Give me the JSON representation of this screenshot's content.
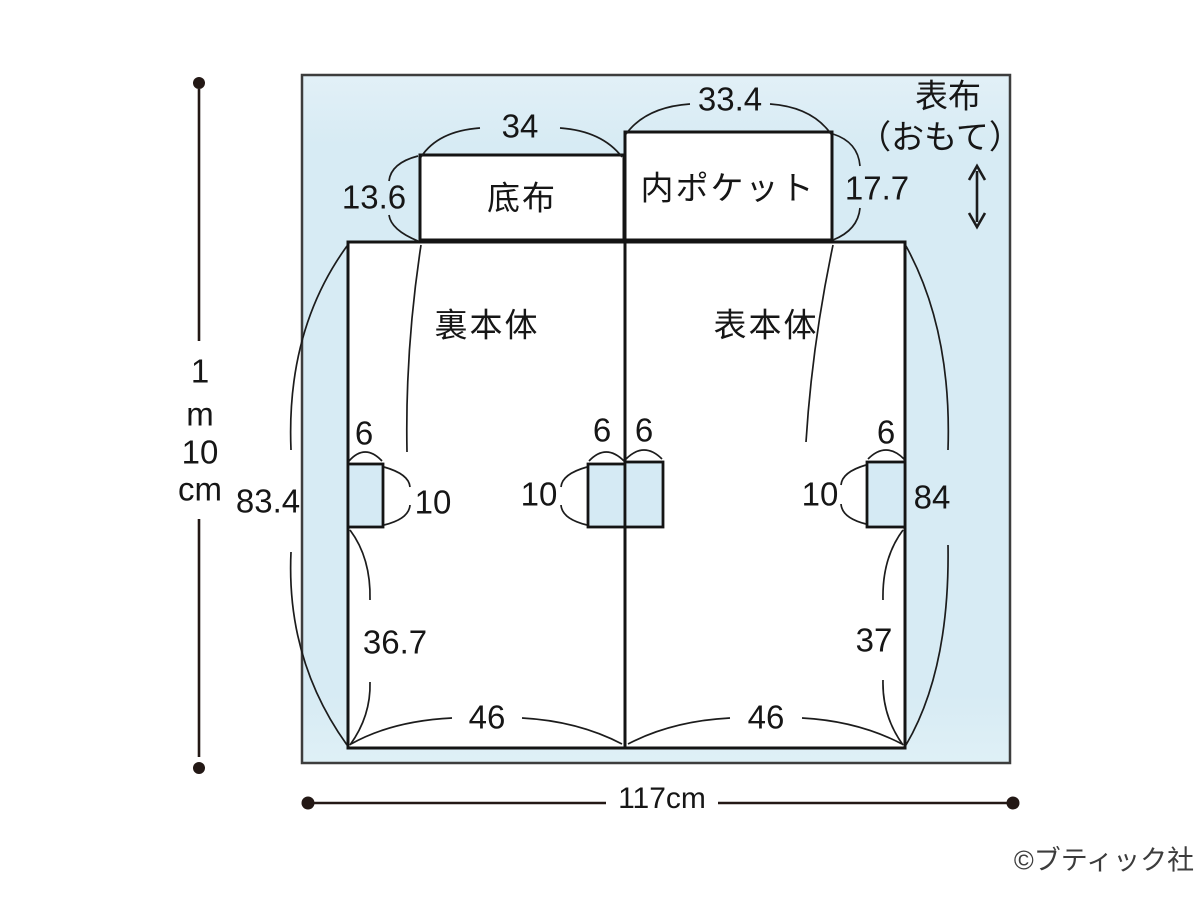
{
  "fabric": {
    "surface_label_1": "表布",
    "surface_label_2": "（おもて）",
    "total_width": "117cm",
    "total_height": [
      "1",
      "m",
      "10",
      "cm"
    ]
  },
  "pieces": {
    "soko": {
      "name": "底布",
      "width": "34",
      "height": "13.6"
    },
    "pocket": {
      "name": "内ポケット",
      "width": "33.4",
      "height": "17.7"
    },
    "ura": {
      "name": "裏本体",
      "height": "83.4",
      "lower_height": "36.7",
      "bottom_width": "46"
    },
    "omote": {
      "name": "表本体",
      "height": "84",
      "lower_height": "37",
      "bottom_width": "46"
    }
  },
  "notch": {
    "width": "6",
    "depth": "10"
  },
  "credit": "©ブティック社",
  "colors": {
    "fabric_fill": "#d9ecf5",
    "line": "#1a1a1a",
    "dim_line": "#231815"
  }
}
